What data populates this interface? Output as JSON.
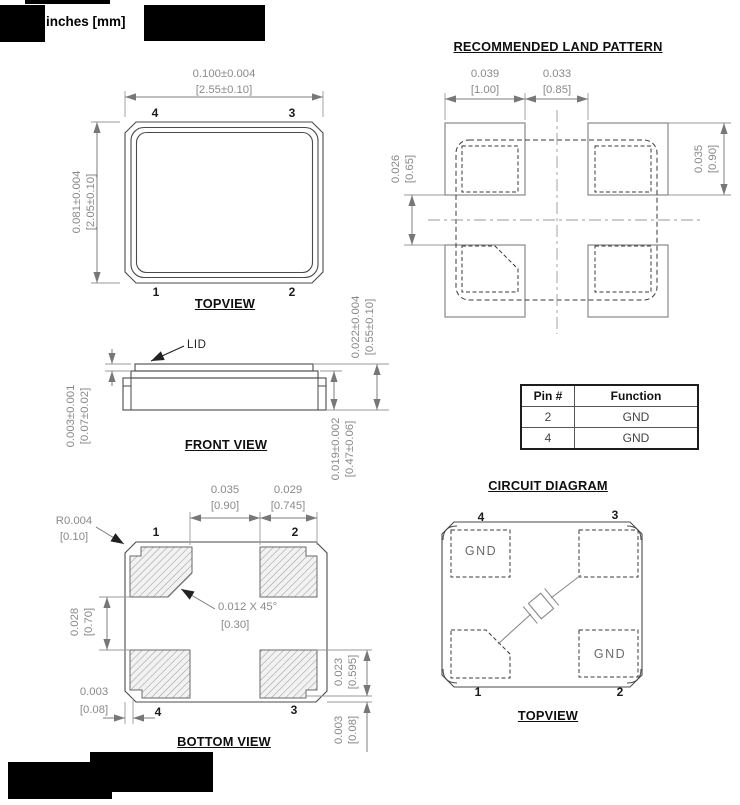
{
  "header": {
    "units_label": "inches [mm]"
  },
  "top_view": {
    "title": "TOPVIEW",
    "dim_width_in": "0.100±0.004",
    "dim_width_mm": "[2.55±0.10]",
    "dim_height_in": "0.081±0.004",
    "dim_height_mm": "[2.05±0.10]",
    "pins": {
      "top_left": "4",
      "top_right": "3",
      "bottom_left": "1",
      "bottom_right": "2"
    }
  },
  "land_pattern": {
    "title": "RECOMMENDED LAND PATTERN",
    "dim_pad_width_in": "0.039",
    "dim_pad_width_mm": "[1.00]",
    "dim_gap_in": "0.033",
    "dim_gap_mm": "[0.85]",
    "dim_pad_height_in": "0.035",
    "dim_pad_height_mm": "[0.90]",
    "dim_vgap_in": "0.026",
    "dim_vgap_mm": "[0.65]"
  },
  "front_view": {
    "title": "FRONT VIEW",
    "lid_label": "LID",
    "dim_lid_in": "0.003±0.001",
    "dim_lid_mm": "[0.07±0.02]",
    "dim_total_height_in": "0.022±0.004",
    "dim_total_height_mm": "[0.55±0.10]",
    "dim_body_height_in": "0.019±0.002",
    "dim_body_height_mm": "[0.47±0.06]"
  },
  "pin_table": {
    "headers": [
      "Pin #",
      "Function"
    ],
    "rows": [
      [
        "2",
        "GND"
      ],
      [
        "4",
        "GND"
      ]
    ]
  },
  "bottom_view": {
    "title": "BOTTOM VIEW",
    "dim_corner_radius_in": "R0.004",
    "dim_corner_radius_mm": "[0.10]",
    "dim_pad_gap_in": "0.035",
    "dim_pad_gap_mm": "[0.90]",
    "dim_pad_width_in": "0.029",
    "dim_pad_width_mm": "[0.745]",
    "dim_pad_vgap_in": "0.028",
    "dim_pad_vgap_mm": "[0.70]",
    "chamfer_note_in": "0.012 X 45°",
    "chamfer_note_mm": "[0.30]",
    "dim_edge_margin_in": "0.003",
    "dim_edge_margin_mm": "[0.08]",
    "dim_pad_height_in": "0.023",
    "dim_pad_height_mm": "[0.595]",
    "dim_bottom_margin_in": "0.003",
    "dim_bottom_margin_mm": "[0.08]",
    "pins": {
      "top_left": "1",
      "top_right": "2",
      "bottom_left": "4",
      "bottom_right": "3"
    }
  },
  "circuit_diagram": {
    "title": "CIRCUIT DIAGRAM",
    "view_label": "TOPVIEW",
    "gnd_top_left": "GND",
    "gnd_bottom_right": "GND",
    "pins": {
      "top_left": "4",
      "top_right": "3",
      "bottom_left": "1",
      "bottom_right": "2"
    }
  },
  "colors": {
    "line": "#4a4a4a",
    "dim": "#7d7d7d",
    "dim_text": "#8a8a8a",
    "redaction": "#000000"
  }
}
